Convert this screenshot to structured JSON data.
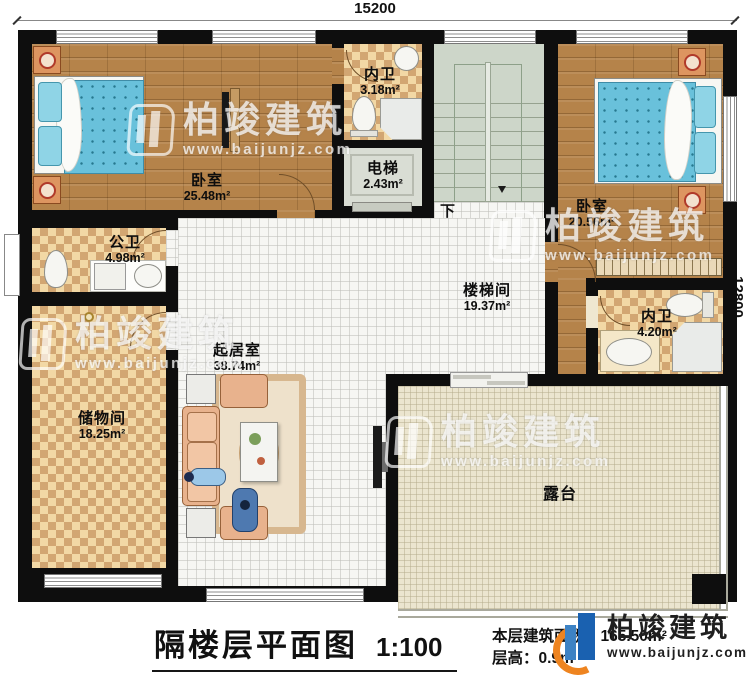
{
  "plan": {
    "dimensions": {
      "top": "15200",
      "right": "12800"
    }
  },
  "stairs": {
    "down_label": "下"
  },
  "rooms": {
    "bedroom_left": {
      "name": "卧室",
      "area": "25.48m²"
    },
    "bath_top": {
      "name": "内卫",
      "area": "3.18m²"
    },
    "elevator": {
      "name": "电梯",
      "area": "2.43m²"
    },
    "bedroom_right": {
      "name": "卧室",
      "area": "20.56m²"
    },
    "stair_hall": {
      "name": "楼梯间",
      "area": "19.37m²"
    },
    "bath_right": {
      "name": "内卫",
      "area": "4.20m²"
    },
    "public_bath": {
      "name": "公卫",
      "area": "4.98m²"
    },
    "living": {
      "name": "起居室",
      "area": "38.74m²"
    },
    "storage": {
      "name": "储物间",
      "area": "18.25m²"
    },
    "terrace": {
      "name": "露台"
    }
  },
  "title_block": {
    "title": "隔楼层平面图",
    "scale": "1:100",
    "area_line": "本层建筑面积：165.50m²",
    "height_line": "层高：0.9m"
  },
  "brand": {
    "name": "柏竣建筑",
    "url": "www.baijunjz.com"
  },
  "watermark": {
    "name": "柏竣建筑",
    "url": "www.baijunjz.com"
  },
  "colors": {
    "wall": "#0e0e0e",
    "wood": "#b5834a",
    "checker_light": "#f2d8a5",
    "checker_dark": "#d2a672",
    "tile": "#f6f6f3",
    "stair": "#cdd6c9",
    "terrace": "#ebe5cf",
    "bed": "#69c1db",
    "sofa": "#e8b28d",
    "brand_blue": "#1a61b0",
    "brand_orange": "#ee8420"
  }
}
